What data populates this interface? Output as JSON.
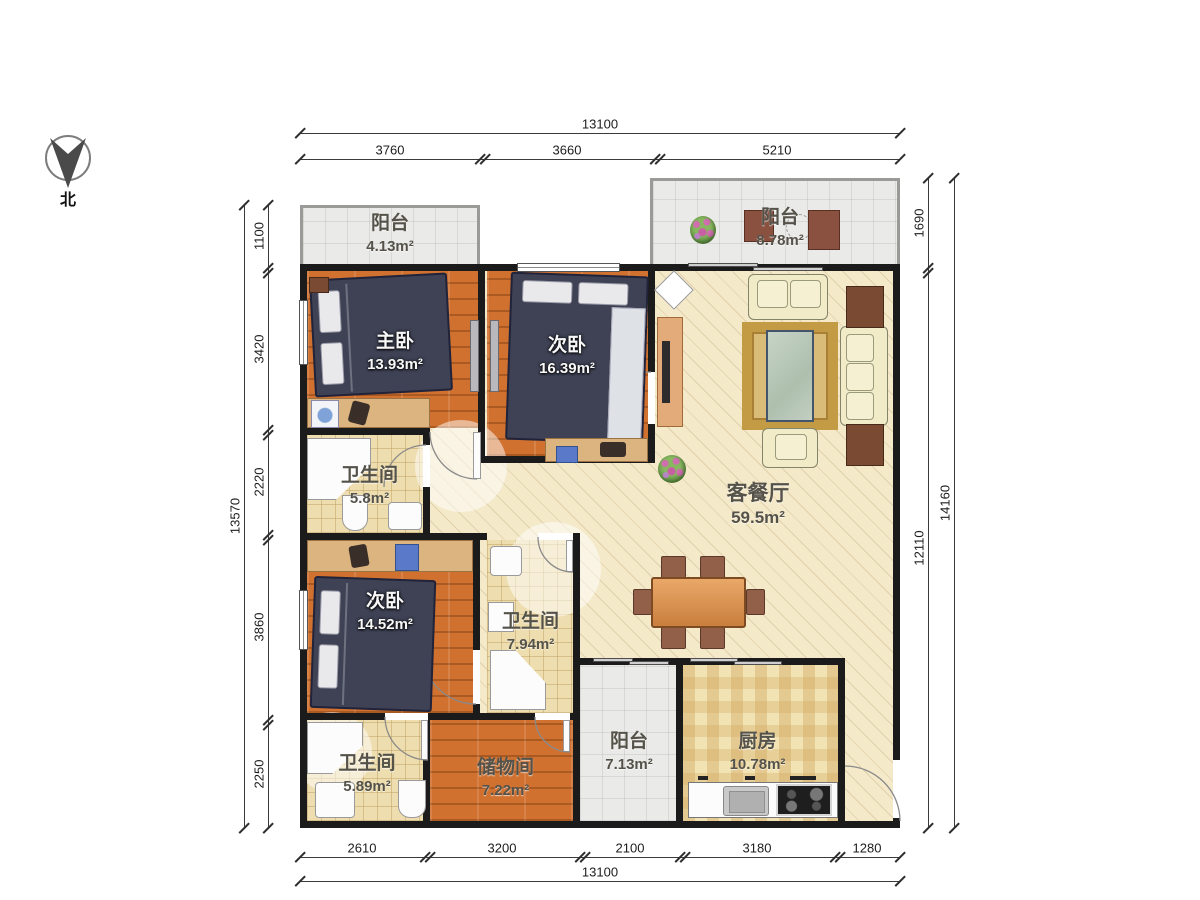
{
  "compass": {
    "label": "北"
  },
  "dimensions": {
    "top": {
      "total": "13100",
      "segments": [
        "3760",
        "3660",
        "5210"
      ]
    },
    "bottom": {
      "total": "13100",
      "segments": [
        "2610",
        "3200",
        "2100",
        "3180",
        "1280"
      ]
    },
    "left": {
      "total": "13570",
      "segments": [
        "1100",
        "3420",
        "2220",
        "3860",
        "2250"
      ]
    },
    "right": {
      "total": "14160",
      "segments": [
        "1690",
        "12110"
      ]
    }
  },
  "rooms": [
    {
      "name": "阳台",
      "area": "4.13m²"
    },
    {
      "name": "主卧",
      "area": "13.93m²"
    },
    {
      "name": "次卧",
      "area": "16.39m²"
    },
    {
      "name": "阳台",
      "area": "8.78m²"
    },
    {
      "name": "客餐厅",
      "area": "59.5m²"
    },
    {
      "name": "卫生间",
      "area": "5.8m²"
    },
    {
      "name": "次卧",
      "area": "14.52m²"
    },
    {
      "name": "卫生间",
      "area": "7.94m²"
    },
    {
      "name": "卫生间",
      "area": "5.89m²"
    },
    {
      "name": "储物间",
      "area": "7.22m²"
    },
    {
      "name": "阳台",
      "area": "7.13m²"
    },
    {
      "name": "厨房",
      "area": "10.78m²"
    }
  ],
  "colors": {
    "wall": "#1b1b1b",
    "wood_floor": "#d0712f",
    "living_floor": "#f4e9c9",
    "bath_tile": "#eeddae",
    "balcony_tile": "#eaeae8",
    "kitchen_tile": "#f2e3b4",
    "bed": "#3e4254",
    "sofa": "#f1ebc8",
    "rug": "#c39b45",
    "dining_table": "#d89050"
  }
}
